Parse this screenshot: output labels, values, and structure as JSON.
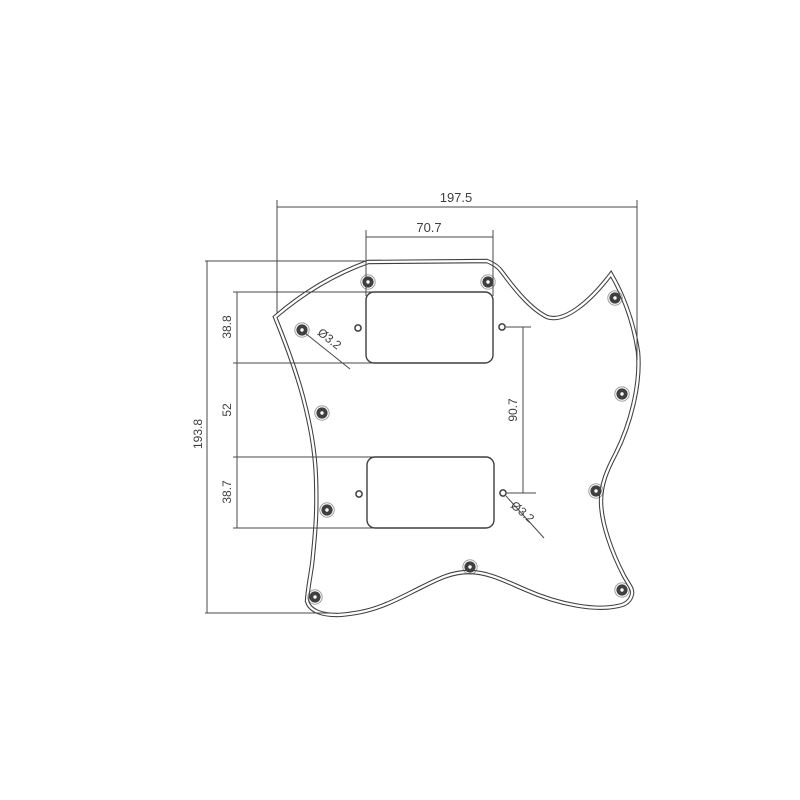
{
  "drawing": {
    "subject": "SG-style guitar pickguard dimensional drawing",
    "background_color": "#ffffff",
    "line_color": "#3f3f3f",
    "dimensions": {
      "overall_width": "197.5",
      "neck_pickup_cutout_width": "70.7",
      "overall_height": "193.8",
      "neck_pickup_cutout_height": "38.8",
      "gap_between_pickup_cutouts": "52",
      "bridge_pickup_cutout_height": "38.7",
      "pickup_hole_vertical_span": "90.7",
      "hole_diameter_upper": "Ø3.2",
      "hole_diameter_lower": "Ø3.2"
    }
  }
}
